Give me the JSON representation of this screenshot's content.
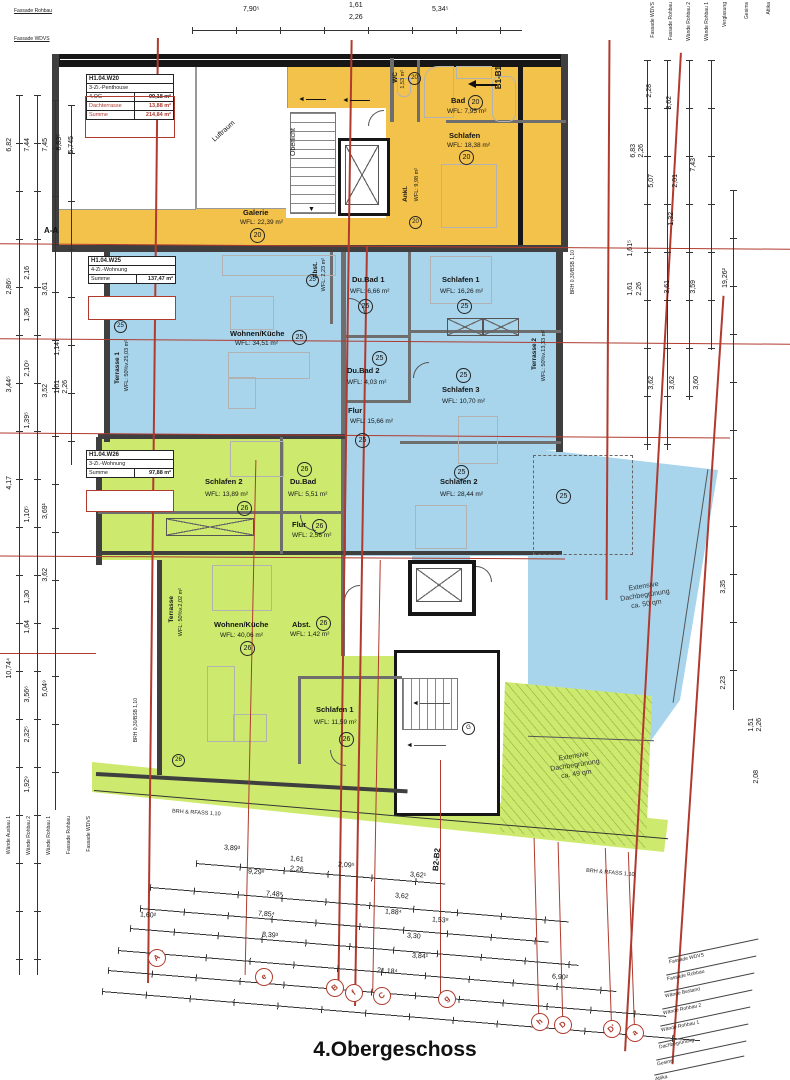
{
  "title": "4.Obergeschoss",
  "colors": {
    "penthouse_fill": "#f3c24b",
    "w25_fill": "#a8d5ec",
    "w26_fill": "#cdea6e",
    "axis_red": "#b03a2e"
  },
  "icons": {
    "arrow_left": "◄",
    "arrow_down": "▼"
  },
  "unit_boxes": {
    "w20": {
      "id": "H1.04.W20",
      "type": "3-Zi.-Penthouse",
      "rows": [
        {
          "label": "4.OG",
          "value": "99,18 m²"
        },
        {
          "label": "Dachterrasse",
          "value": "13,88 m²"
        },
        {
          "label": "Summe",
          "value": "214,84 m²"
        }
      ]
    },
    "w25": {
      "id": "H1.04.W25",
      "type": "4-Zi.-Wohnung",
      "rows": [
        {
          "label": "Summe",
          "value": "137,47 m²"
        }
      ]
    },
    "w26": {
      "id": "H1.04.W26",
      "type": "3-Zi.-Wohnung",
      "rows": [
        {
          "label": "Summe",
          "value": "97,88 m²"
        }
      ]
    }
  },
  "rooms": {
    "orange": [
      {
        "name": "WC",
        "area": "1,53 m²",
        "nr": "20"
      },
      {
        "name": "Bad",
        "area": "WFL: 7,95 m²",
        "nr": "20"
      },
      {
        "name": "Schlafen",
        "area": "WFL: 18,38 m²",
        "nr": "20"
      },
      {
        "name": "Ankl.",
        "area": "WFL: 9,98 m²",
        "nr": "20"
      },
      {
        "name": "Galerie",
        "area": "WFL: 22,39 m²",
        "nr": "20"
      },
      {
        "name": "Oberlicht"
      },
      {
        "name": "Luftraum"
      }
    ],
    "blue": [
      {
        "name": "Wohnen/Küche",
        "area": "WFL: 34,51 m²",
        "nr": "25"
      },
      {
        "name": "Abst.",
        "area": "WFL: 2,23 m²",
        "nr": "25"
      },
      {
        "name": "Du.Bad 1",
        "area": "WFL: 6,66 m²",
        "nr": "25"
      },
      {
        "name": "Schlafen 1",
        "area": "WFL: 16,26 m²",
        "nr": "25"
      },
      {
        "name": "Du.Bad 2",
        "area": "WFL: 4,03 m²",
        "nr": "25"
      },
      {
        "name": "Schlafen 3",
        "area": "WFL: 10,70 m²",
        "nr": "25"
      },
      {
        "name": "Flur",
        "area": "WFL: 15,66 m²",
        "nr": "25"
      },
      {
        "name": "Schlafen 2",
        "area": "WFL: 28,44 m²",
        "nr": "25"
      },
      {
        "name": "Terrasse 1",
        "area": "WFL: 50%v.25,03 m²",
        "nr": "25"
      },
      {
        "name": "Terrasse 2",
        "area": "WFL: 50%v.13,33 m²"
      }
    ],
    "green": [
      {
        "name": "Schlafen 2",
        "area": "WFL: 13,89 m²",
        "nr": "26"
      },
      {
        "name": "Du.Bad",
        "area": "WFL: 5,51 m²",
        "nr": "26"
      },
      {
        "name": "Flur",
        "area": "WFL: 2,56 m²",
        "nr": "26"
      },
      {
        "name": "Wohnen/Küche",
        "area": "WFL: 40,06 m²",
        "nr": "26"
      },
      {
        "name": "Abst.",
        "area": "WFL: 1,42 m²",
        "nr": "26"
      },
      {
        "name": "Schlafen 1",
        "area": "WFL: 11,59 m²",
        "nr": "26"
      },
      {
        "name": "Terrasse",
        "area": "WFL: 50%v.2,02 m²",
        "nr": "26"
      }
    ]
  },
  "roof": {
    "blue": {
      "l1": "Extensive",
      "l2": "Dachbegrünung",
      "l3": "ca. 50 qm",
      "nr": "25"
    },
    "green": {
      "l1": "Extensive",
      "l2": "Dachbegrünung",
      "l3": "ca. 49 qm"
    }
  },
  "markers": {
    "b1": "B1-B1",
    "b2": "B2-B2",
    "aa": "A-A",
    "stair": "G"
  },
  "grid_bubbles": [
    "A",
    "e",
    "B",
    "f",
    "C",
    "g",
    "h",
    "D",
    "D'",
    "a"
  ],
  "dims": {
    "top": [
      "7,90⁵",
      "1,61",
      "2,26",
      "5,34⁵"
    ],
    "bottom": [
      "3,89³",
      "1,61",
      "2,26",
      "2,09⁵",
      "3,62¹",
      "9,29⁶",
      "7,48⁸",
      "3,62",
      "7,85⁴",
      "1,88⁴",
      "1,53⁸",
      "1,60²",
      "8,39³",
      "3,30",
      "3,84¹",
      "21,18⁴",
      "6,90²"
    ],
    "left": [
      "6,82",
      "7,44",
      "7,45",
      "6,83⁵",
      "5,745",
      "2,86⁵",
      "2,16",
      "3,61",
      "1,36",
      "1,14",
      "2,10⁹",
      "3,44⁵",
      "3,52",
      "1,61",
      "2,26",
      "1,39⁵",
      "4,17",
      "1,10⁵",
      "3,69¹",
      "3,62",
      "1,30",
      "1,64",
      "10,74⁴",
      "3,56⁶",
      "5,04⁹",
      "2,32⁵",
      "1,92⁹"
    ],
    "right": [
      "2,28",
      "3,62",
      "6,83",
      "2,26",
      "5,07",
      "2,01",
      "7,43",
      "1,32",
      "1,61⁵",
      "1,61",
      "2,26",
      "3,61",
      "3,59",
      "19,26²",
      "3,62",
      "3,62",
      "3,60",
      "3,35",
      "2,23",
      "2,08",
      "1,51",
      "2,26"
    ]
  },
  "annotations": {
    "brh_left": "BRH 0,30/BSB 1,10",
    "brh_right": "BRH 0,30/BSB 1,10",
    "brh_bottom1": "BRH & RFASS 1,10",
    "brh_bottom2": "BRH & RFASS 1,10",
    "layers_topleft": [
      "Fassade Rohbau",
      "Fassade WDVS"
    ],
    "layers_topright": [
      "Fassade WDVS",
      "Fassade Rohbau",
      "Wände Rohbau 2",
      "Wände Rohbau 1",
      "Verglasung",
      "Gesims",
      "Attika"
    ],
    "layers_bottomleft": [
      "Wände Ausbau 1",
      "Wände Rohbau 2",
      "Wände Rohbau 1",
      "Fassade Rohbau",
      "Fassade WDVS"
    ],
    "layers_bottomright": [
      "Fassade WDVS",
      "Fassade Rohbau",
      "Wände Bestand",
      "Wände Rohbau 2",
      "Wände Rohbau 1",
      "Dachbegrünung",
      "Gesims",
      "Attika"
    ]
  }
}
